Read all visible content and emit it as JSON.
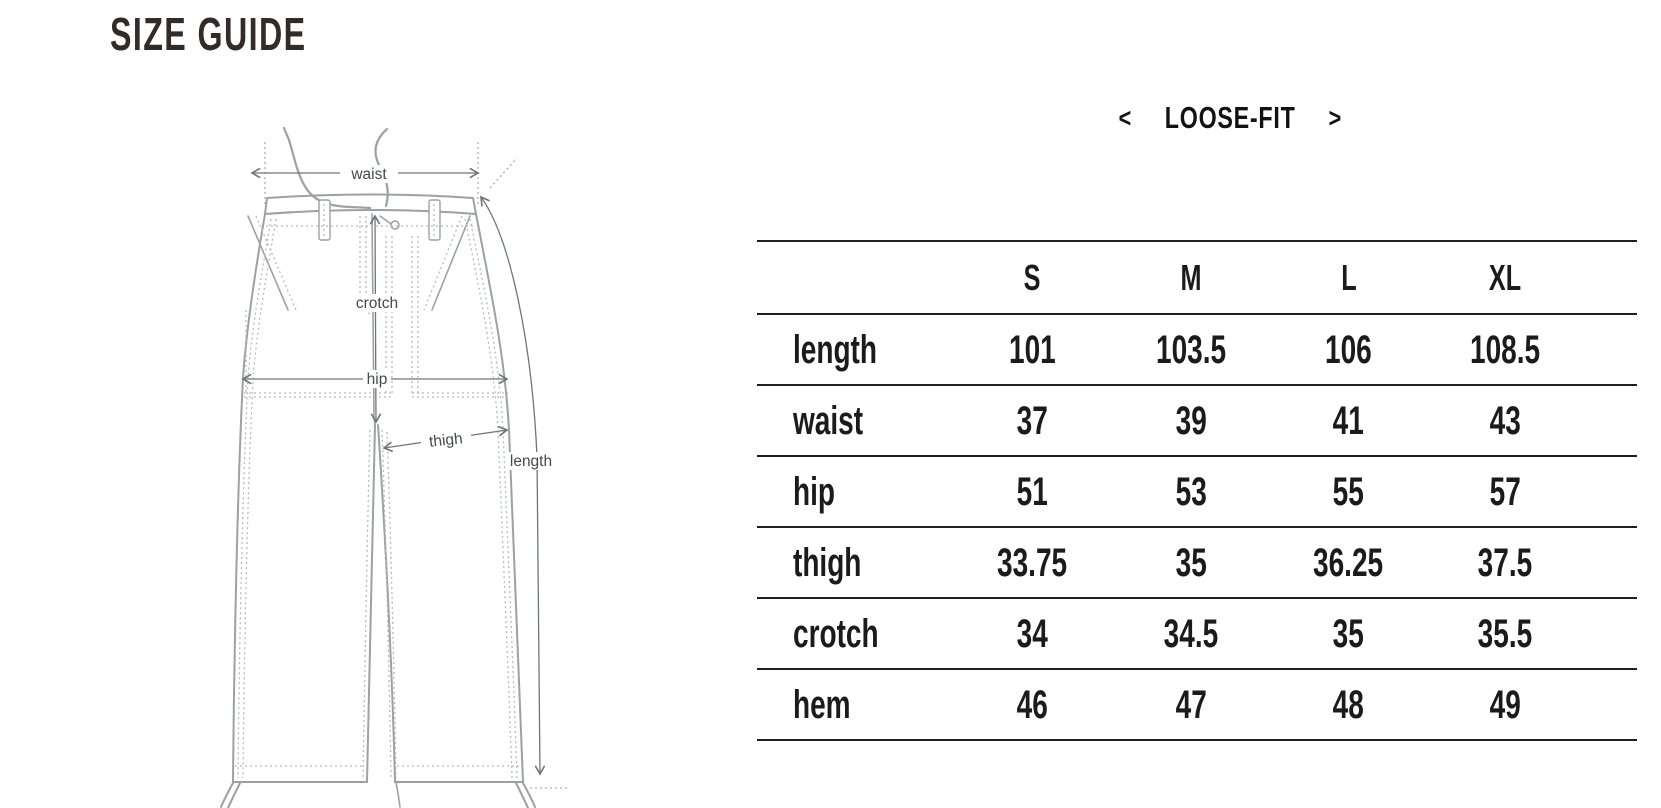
{
  "page": {
    "title": "SIZE GUIDE"
  },
  "fit_selector": {
    "prev_arrow": "<",
    "label": "LOOSE-FIT",
    "next_arrow": ">"
  },
  "diagram": {
    "labels": {
      "waist": "waist",
      "crotch": "crotch",
      "hip": "hip",
      "thigh": "thigh",
      "length": "length"
    }
  },
  "size_table": {
    "columns": [
      "S",
      "M",
      "L",
      "XL"
    ],
    "rows": [
      {
        "label": "length",
        "values": [
          "101",
          "103.5",
          "106",
          "108.5"
        ]
      },
      {
        "label": "waist",
        "values": [
          "37",
          "39",
          "41",
          "43"
        ]
      },
      {
        "label": "hip",
        "values": [
          "51",
          "53",
          "55",
          "57"
        ]
      },
      {
        "label": "thigh",
        "values": [
          "33.75",
          "35",
          "36.25",
          "37.5"
        ]
      },
      {
        "label": "crotch",
        "values": [
          "34",
          "34.5",
          "35",
          "35.5"
        ]
      },
      {
        "label": "hem",
        "values": [
          "46",
          "47",
          "48",
          "49"
        ]
      }
    ]
  },
  "colors": {
    "background": "#ffffff",
    "title_text": "#332b27",
    "table_text": "#1b1b1b",
    "table_line": "#1f1f1f",
    "diagram_line": "#9ba1a5",
    "diagram_stitch": "#b5babd",
    "diagram_arrow": "#6f767b",
    "diagram_label": "#45494c"
  }
}
